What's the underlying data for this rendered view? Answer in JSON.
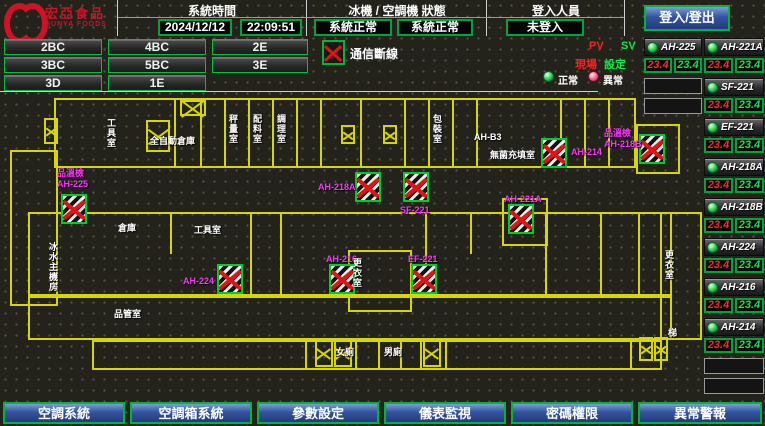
{
  "header": {
    "logo": {
      "name_zh": "宏亞食品",
      "name_en": "HUNYA FOODS"
    },
    "system_time": {
      "label": "系統時間",
      "date": "2024/12/12",
      "time": "22:09:51"
    },
    "chiller_status": {
      "label": "冰機 / 空調機 狀態",
      "chiller": "系統正常",
      "ahu": "系統正常"
    },
    "login": {
      "label": "登入人員",
      "user": "未登入",
      "button": "登入/登出"
    }
  },
  "floor_buttons": [
    "2BC",
    "4BC",
    "2E",
    "3BC",
    "5BC",
    "3E",
    "3D",
    "1E"
  ],
  "legend": {
    "comm_lost": "通信斷線",
    "normal": "正常",
    "abnormal": "異常",
    "pv": "PV",
    "sv": "SV",
    "pv_desc": "現場",
    "sv_desc": "設定"
  },
  "units": [
    {
      "name": "AH-225",
      "pv": "23.4",
      "sv": "23.4"
    },
    {
      "name": "AH-221A",
      "pv": "23.4",
      "sv": "23.4"
    },
    {
      "name": "SF-221",
      "pv": "23.4",
      "sv": "23.4"
    },
    {
      "name": "EF-221",
      "pv": "23.4",
      "sv": "23.4"
    },
    {
      "name": "AH-218A",
      "pv": "23.4",
      "sv": "23.4"
    },
    {
      "name": "AH-218B",
      "pv": "23.4",
      "sv": "23.4"
    },
    {
      "name": "AH-224",
      "pv": "23.4",
      "sv": "23.4"
    },
    {
      "name": "AH-216",
      "pv": "23.4",
      "sv": "23.4"
    },
    {
      "name": "AH-214",
      "pv": "23.4",
      "sv": "23.4"
    }
  ],
  "floorplan": {
    "markers": [
      {
        "l1": "品溫檢",
        "l2": "AH-225"
      },
      {
        "l1": "AH-224"
      },
      {
        "l1": "AH-218A"
      },
      {
        "l1": "SF-221"
      },
      {
        "l1": "AH-216"
      },
      {
        "l1": "EF-221"
      },
      {
        "l1": "AH-214"
      },
      {
        "l1": "品溫檢",
        "l2": "AH-218B"
      },
      {
        "l1": "AH-221A"
      }
    ],
    "room_labels": [
      {
        "text": "工具室"
      },
      {
        "text": "全自動倉庫"
      },
      {
        "text": "秤量室"
      },
      {
        "text": "配料室"
      },
      {
        "text": "調理室"
      },
      {
        "text": "包裝室"
      },
      {
        "text": "AH-B3"
      },
      {
        "text": "無菌充填室"
      },
      {
        "text": "倉庫"
      },
      {
        "text": "工具室"
      },
      {
        "text": "冰水主機房"
      },
      {
        "text": "品管室"
      },
      {
        "text": "更衣室"
      },
      {
        "text": "更衣室"
      },
      {
        "text": "女廁"
      },
      {
        "text": "男廁"
      },
      {
        "text": "梯"
      }
    ]
  },
  "bottom_nav": [
    "空調系統",
    "空調箱系統",
    "參數設定",
    "儀表監視",
    "密碼權限",
    "異常警報"
  ],
  "colors": {
    "accent_green": "#00b43c",
    "alarm_red": "#ff2020",
    "magenta": "#ff33ff",
    "wall_yellow": "#d6d600",
    "button_blue": "#34549e",
    "logo_red": "#cf1326"
  }
}
